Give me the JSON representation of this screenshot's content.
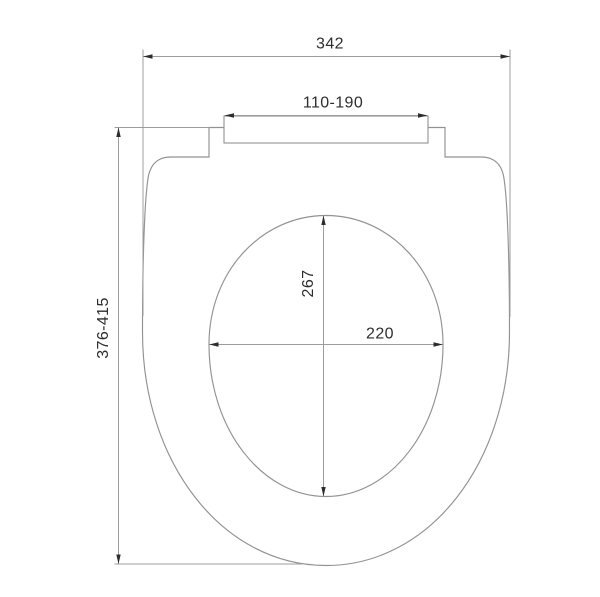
{
  "drawing": {
    "subject": "toilet-seat-top-view-dimension-diagram",
    "colors": {
      "line": "#9c9c9c",
      "text": "#2d2d2d",
      "background": "#ffffff"
    },
    "dimensions": {
      "overall_width": "342",
      "hinge_mount_width": "110-190",
      "overall_length": "376-415",
      "inner_opening_length": "267",
      "inner_opening_width": "220"
    }
  }
}
